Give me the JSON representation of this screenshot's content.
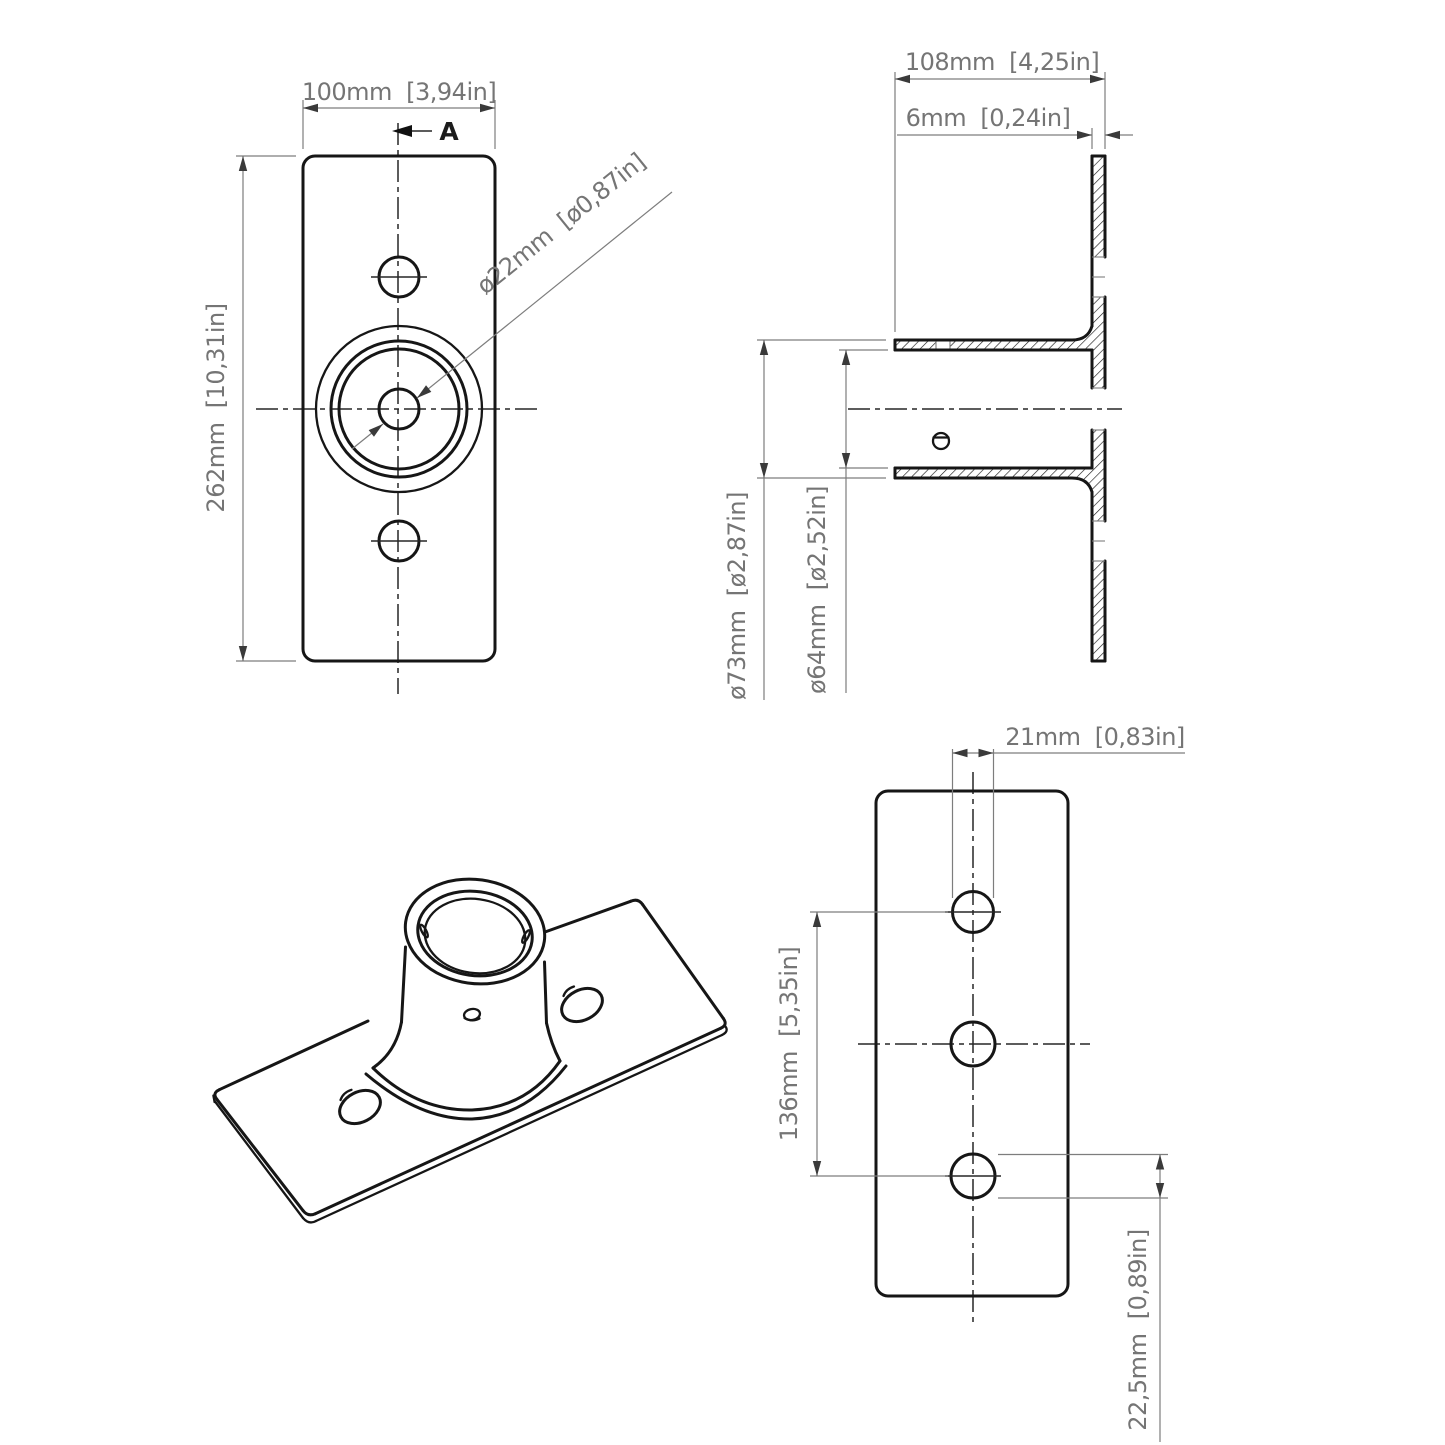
{
  "colors": {
    "background": "#ffffff",
    "object_line": "#161616",
    "dim_line": "#7d7d7d",
    "centerline": "#272727",
    "text_color": "#757575"
  },
  "front_view": {
    "width_dim": "100mm  [3,94in]",
    "height_dim": "262mm  [10,31in]",
    "hole_dia_dim": "ø22mm  [ø0,87in]",
    "section_label": "A"
  },
  "section_view": {
    "depth_dim": "108mm  [4,25in]",
    "plate_thickness_dim": "6mm  [0,24in]",
    "outer_dia_dim": "ø73mm  [ø2,87in]",
    "inner_dia_dim": "ø64mm  [ø2,52in]"
  },
  "back_view": {
    "hole_dia_dim": "21mm  [0,83in]",
    "hole_spacing_dim": "136mm  [5,35in]",
    "edge_distance_dim": "22,5mm  [0,89in]"
  }
}
